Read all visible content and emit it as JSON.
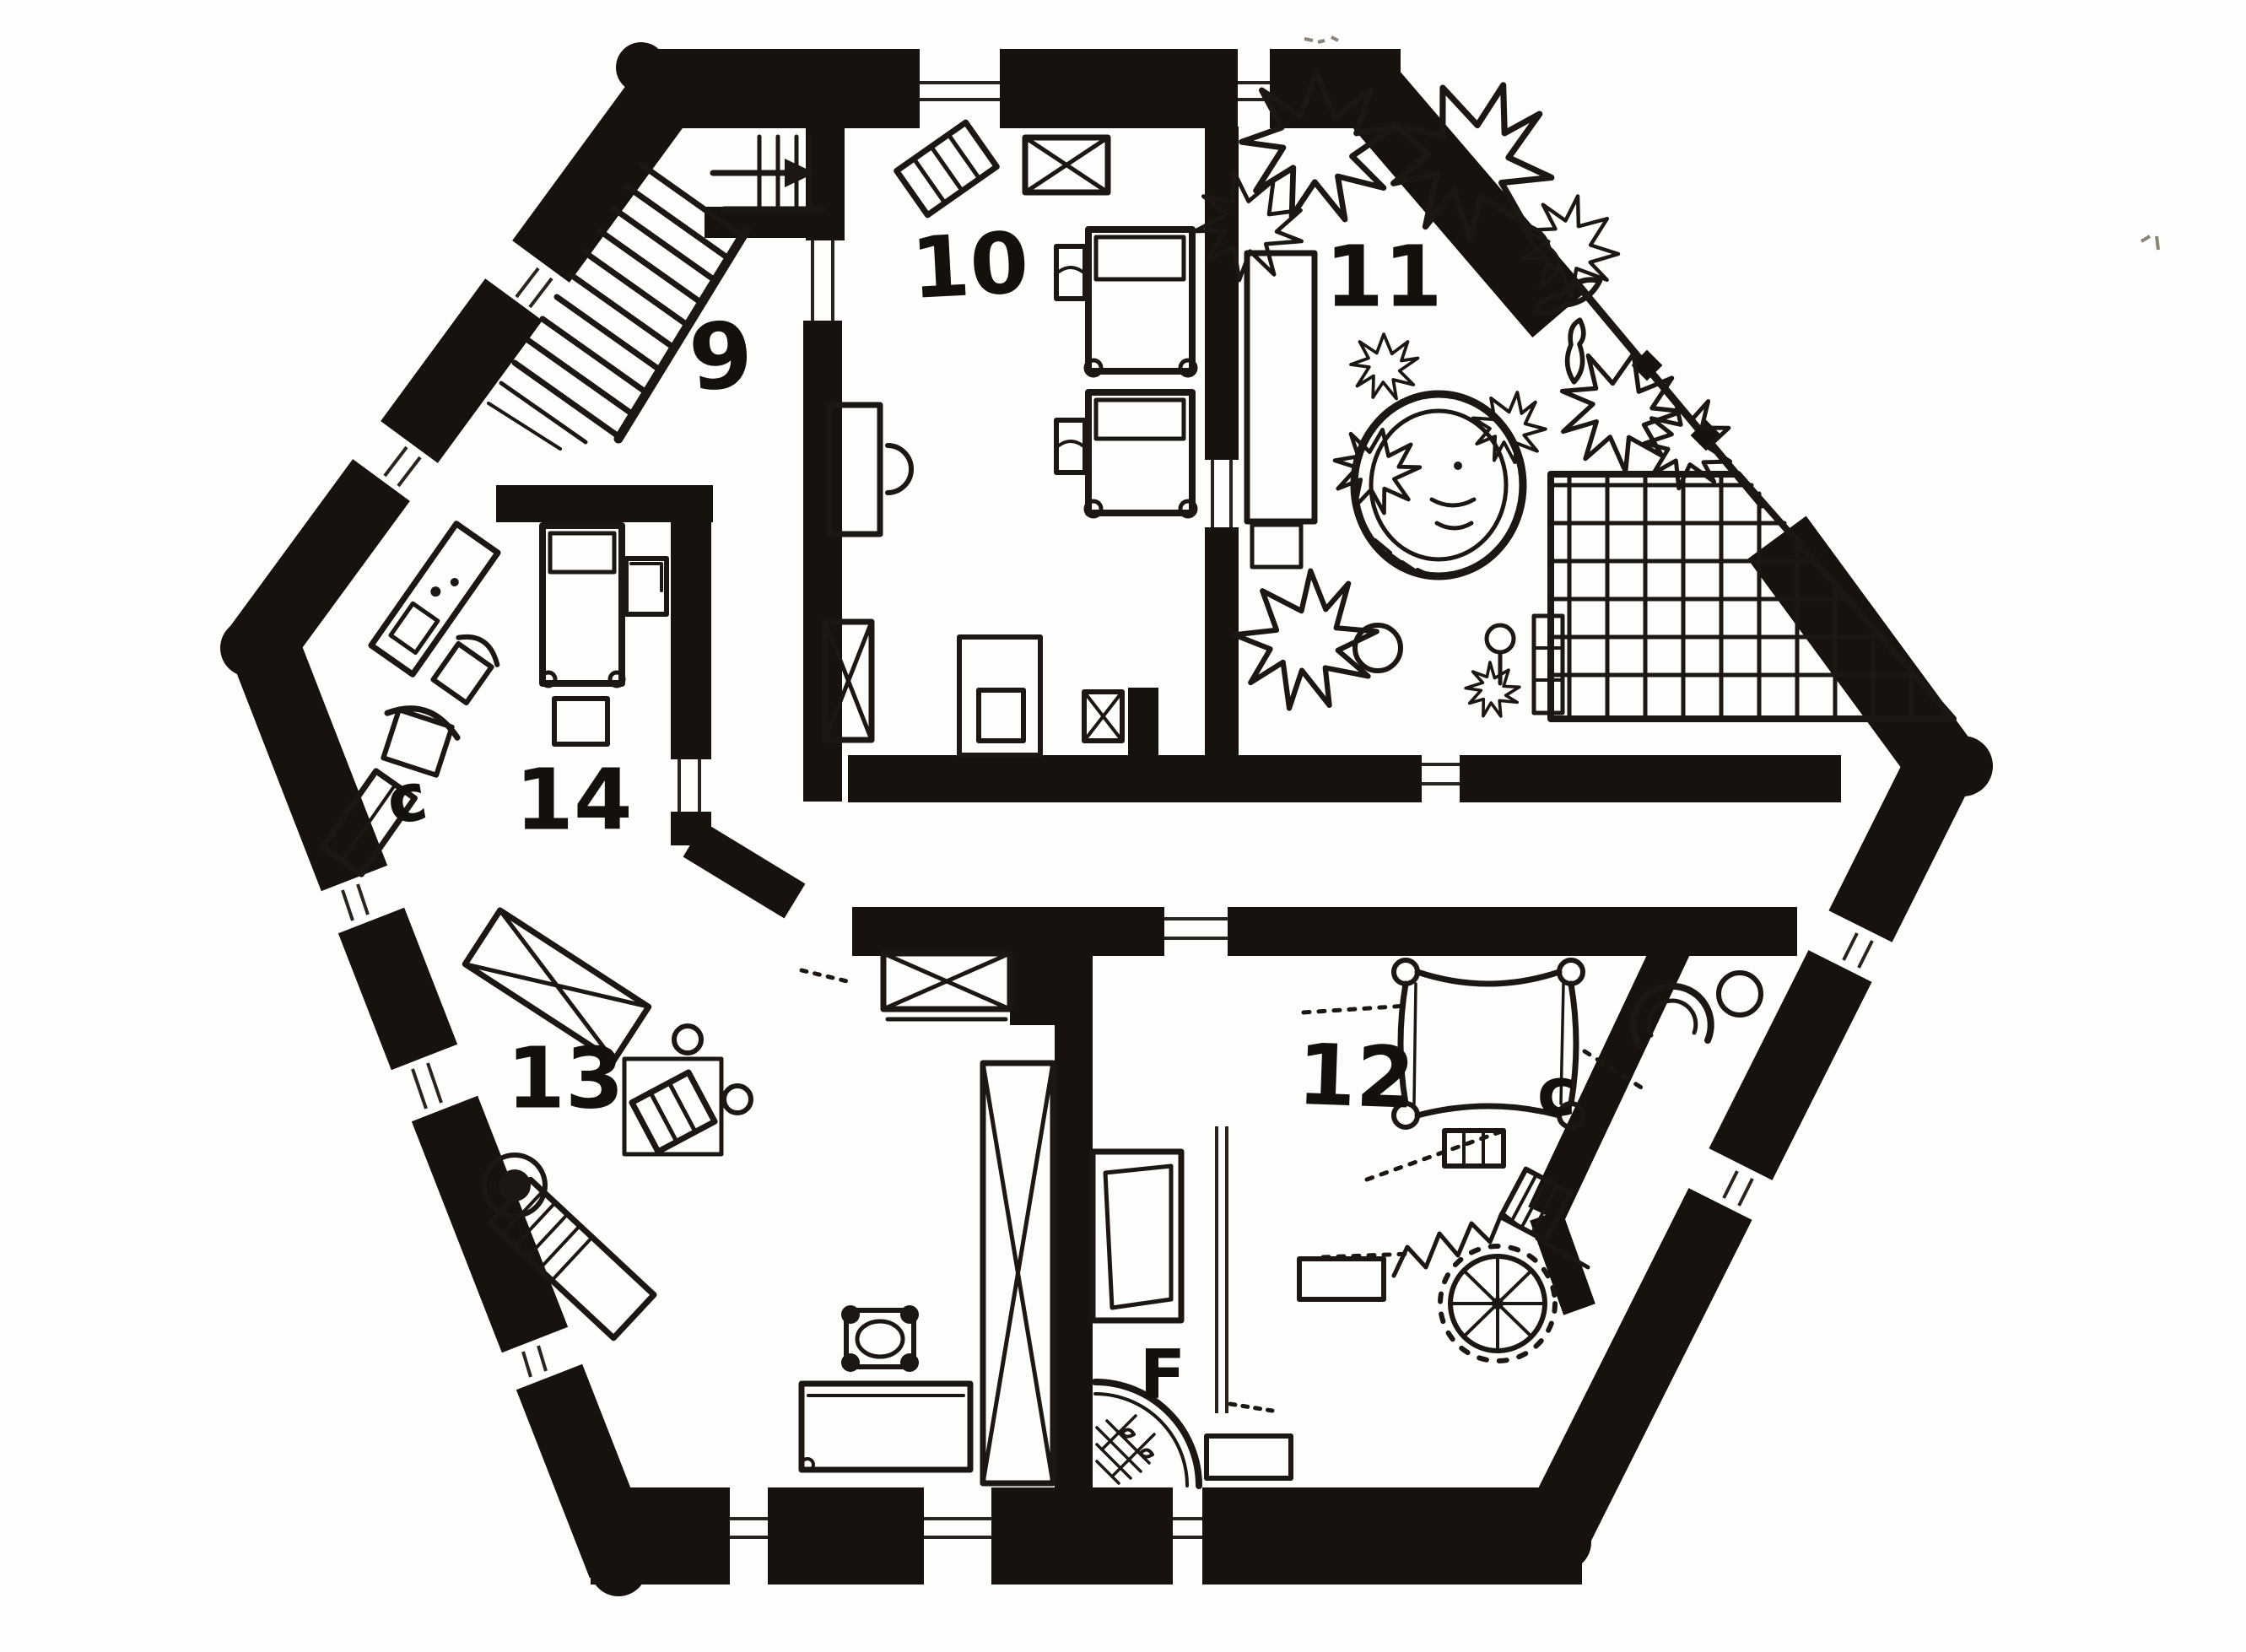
{
  "title": "Hand-drawn hexagonal floor plan, upper level",
  "colors": {
    "paper": "#fdfdfb",
    "ink": "#1c1712",
    "wall": "#17120e"
  },
  "rooms": [
    {
      "id": "9",
      "label": "9",
      "name": "stair-hall"
    },
    {
      "id": "10",
      "label": "10",
      "name": "bedroom-top-center"
    },
    {
      "id": "11",
      "label": "11",
      "name": "roof-terrace-garden"
    },
    {
      "id": "12",
      "label": "12",
      "name": "bedroom-bottom-right"
    },
    {
      "id": "13",
      "label": "13",
      "name": "bedroom-bottom-left"
    },
    {
      "id": "14",
      "label": "14",
      "name": "bedroom-left"
    }
  ],
  "annotations": [
    {
      "id": "c14",
      "label": "c",
      "name": "closet-of-room-14"
    },
    {
      "id": "c12",
      "label": "c",
      "name": "closet-of-room-12"
    },
    {
      "id": "F",
      "label": "F",
      "name": "bathroom"
    }
  ],
  "features": {
    "stairs": "L-shaped staircase with up-arrow in room 9",
    "spiral_stairs": "spiral staircase lower right",
    "hot_tub": "round tub on terrace 11",
    "deck": "gridded deck on terrace 11"
  }
}
